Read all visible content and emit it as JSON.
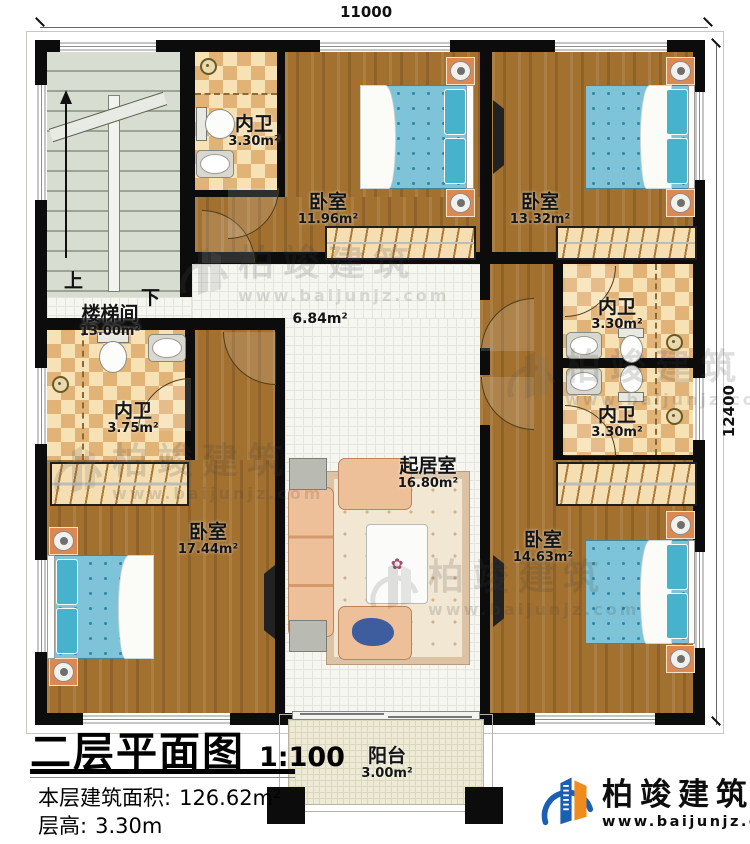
{
  "dimensions": {
    "top": "11000",
    "right": "12400"
  },
  "stairs": {
    "up": "上",
    "down": "下"
  },
  "rooms": [
    {
      "name": "楼梯间",
      "area": "13.00m²"
    },
    {
      "name": "内卫",
      "area": "3.30m²"
    },
    {
      "name": "卧室",
      "area": "11.96m²"
    },
    {
      "name": "卧室",
      "area": "13.32m²"
    },
    {
      "name": "",
      "area": "6.84m²"
    },
    {
      "name": "内卫",
      "area": "3.30m²"
    },
    {
      "name": "内卫",
      "area": "3.30m²"
    },
    {
      "name": "内卫",
      "area": "3.75m²"
    },
    {
      "name": "起居室",
      "area": "16.80m²"
    },
    {
      "name": "卧室",
      "area": "17.44m²"
    },
    {
      "name": "卧室",
      "area": "14.63m²"
    },
    {
      "name": "阳台",
      "area": "3.00m²"
    }
  ],
  "title_block": {
    "heading": "二层平面图",
    "scale": "1:100",
    "area_label": "本层建筑面积:",
    "area_value": "126.62m²",
    "height_label": "层高:",
    "height_value": "3.30m"
  },
  "brand": {
    "name": "柏竣建筑",
    "url": "www.baijunjz.com"
  },
  "colors": {
    "wall": "#0c0c0c",
    "wood": "#a2702f",
    "checker_tan": "#e2b377",
    "bed_blue": "#7ec3d7",
    "logo_blue": "#1a5fb4",
    "logo_orange": "#f08c1e"
  }
}
